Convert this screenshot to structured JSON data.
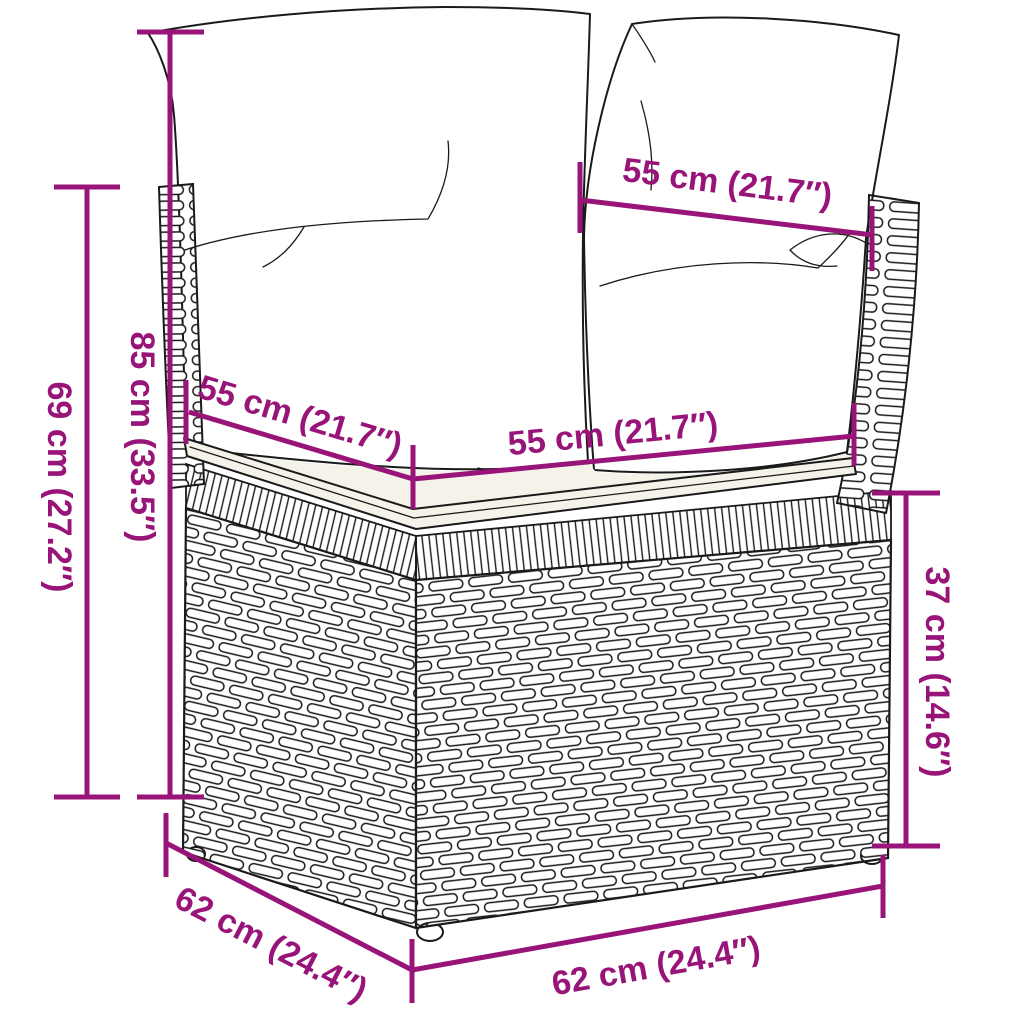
{
  "figure": {
    "subject": "poly-rattan corner sofa section with back and seat cushions",
    "background": "#ffffff",
    "dimension_color": "#991478",
    "sketch_color": "#1a1a1a"
  },
  "dimensions": {
    "back_total_height": {
      "label": "85 cm (33.5″)"
    },
    "arm_frame_height": {
      "label": "69 cm (27.2″)"
    },
    "back_cushion_width": {
      "label": "55 cm (21.7″)"
    },
    "seat_depth": {
      "label": "55 cm (21.7″)"
    },
    "seat_width": {
      "label": "55 cm (21.7″)"
    },
    "base_height": {
      "label": "37 cm (14.6″)"
    },
    "base_depth": {
      "label": "62 cm (24.4″)"
    },
    "base_width": {
      "label": "62 cm (24.4″)"
    }
  }
}
